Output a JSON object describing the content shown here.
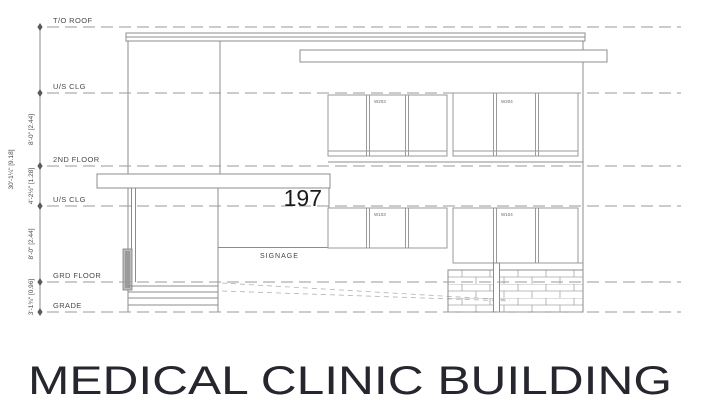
{
  "drawing": {
    "sheet_title": "MEDICAL CLINIC BUILDING",
    "address_number": "197",
    "signage_label": "SIGNAGE",
    "levels": [
      {
        "label": "T/O ROOF"
      },
      {
        "label": "U/S CLG"
      },
      {
        "label": "2ND FLOOR"
      },
      {
        "label": "U/S CLG"
      },
      {
        "label": "GRD FLOOR"
      },
      {
        "label": "GRADE"
      }
    ],
    "dimensions": {
      "overall": "30'-1¼\" [9.18]",
      "segments": [
        "8'-0\" [2.44]",
        "4'-2½\" [1.28]",
        "8'-0\" [2.44]",
        "3'-1¾\" [0.96]"
      ]
    },
    "windows": [
      {
        "label": "W203"
      },
      {
        "label": "W204"
      },
      {
        "label": "W103"
      },
      {
        "label": "W104"
      }
    ],
    "line_color": "#8c8c8c",
    "dash_color": "#9a9a9a",
    "text_color": "#4a4a4a"
  }
}
